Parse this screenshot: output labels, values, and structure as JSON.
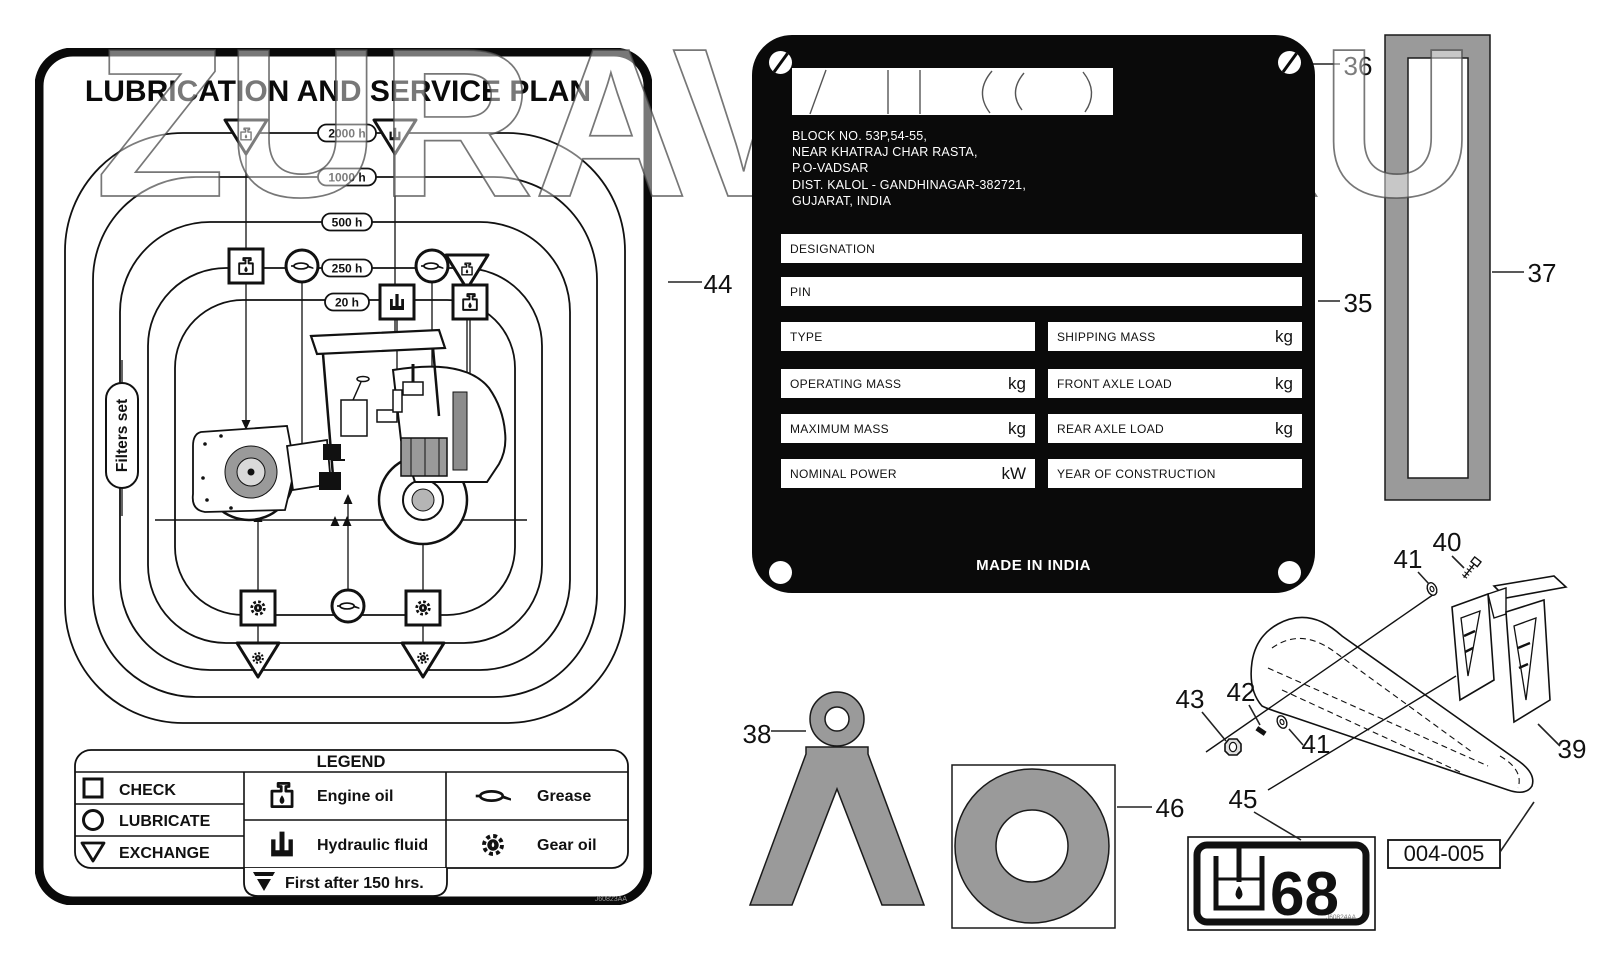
{
  "page": {
    "background": "#ffffff"
  },
  "colors": {
    "part_gray": "#9a9a9a",
    "plate_black": "#0a0a0a",
    "watermark_stroke": "#4a4a4a"
  },
  "watermark": {
    "text": "ZURAVTO.RU"
  },
  "service_plan": {
    "title": "LUBRICATION AND SERVICE PLAN",
    "intervals": [
      "2000 h",
      "1000 h",
      "500 h",
      "250 h",
      "20 h"
    ],
    "filters_label": "Filters set",
    "doc_code": "J60823AA",
    "legend": {
      "title": "LEGEND",
      "check": "CHECK",
      "lubricate": "LUBRICATE",
      "exchange": "EXCHANGE",
      "engine_oil": "Engine oil",
      "hydraulic_fluid": "Hydraulic fluid",
      "grease": "Grease",
      "gear_oil": "Gear oil",
      "first_after": "First after 150 hrs."
    }
  },
  "nameplate": {
    "address": [
      "BLOCK NO. 53P,54-55,",
      "NEAR KHATRAJ CHAR RASTA,",
      "P.O-VADSAR",
      "DIST. KALOL - GANDHINAGAR-382721,",
      "GUJARAT, INDIA"
    ],
    "fields": {
      "designation": "DESIGNATION",
      "pin": "PIN",
      "type": "TYPE",
      "shipping_mass": "SHIPPING MASS",
      "operating_mass": "OPERATING MASS",
      "front_axle_load": "FRONT AXLE LOAD",
      "maximum_mass": "MAXIMUM MASS",
      "rear_axle_load": "REAR AXLE LOAD",
      "nominal_power": "NOMINAL POWER",
      "year_of_construction": "YEAR OF CONSTRUCTION"
    },
    "units": {
      "kg": "kg",
      "kw": "kW"
    },
    "made_in": "MADE IN INDIA"
  },
  "decal_oil": {
    "grade": "68",
    "code": "J60824AA"
  },
  "callouts": {
    "n35": "35",
    "n36": "36",
    "n37": "37",
    "n38": "38",
    "n39": "39",
    "n40": "40",
    "n41": "41",
    "n42": "42",
    "n43": "43",
    "n44": "44",
    "n45": "45",
    "n46": "46",
    "ref": "004-005"
  }
}
